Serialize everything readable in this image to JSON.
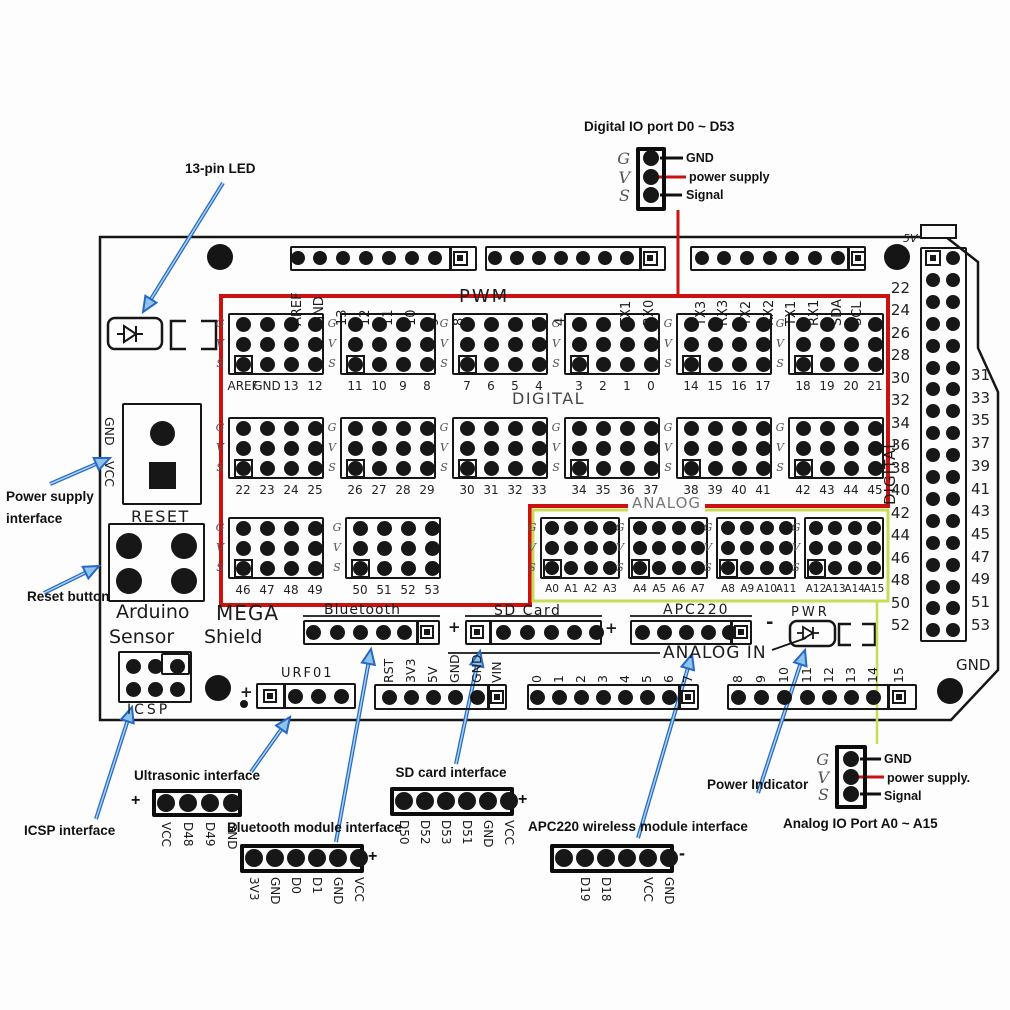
{
  "colors": {
    "red": "#cc1111",
    "yellow_green": "#c9dc55",
    "arrow_blue": "#2668c4",
    "arrow_fill": "#8ec4ec",
    "ink": "#161616"
  },
  "callouts": {
    "digital_io_title": "Digital IO port D0 ~ D53",
    "analog_io_title": "Analog IO Port A0 ~ A15",
    "led": "13-pin LED",
    "power_supply_line1": "Power supply",
    "power_supply_line2": "interface",
    "reset_button": "Reset button",
    "icsp": "ICSP interface",
    "power_indicator": "Power Indicator",
    "legend_top": {
      "g": "G",
      "v": "V",
      "s": "S",
      "gnd": "GND",
      "power": "power supply",
      "signal": "Signal"
    },
    "legend_bottom": {
      "g": "G",
      "v": "V",
      "s": "S",
      "gnd": "GND",
      "power": "power supply.",
      "signal": "Signal"
    }
  },
  "board": {
    "five_v": "5V",
    "pwm": "PWM",
    "digital": "DIGITAL",
    "digital_side": "DIGITAL",
    "analog": "ANALOG",
    "analog_in": "ANALOG IN",
    "gnd_corner": "GND",
    "gvs": [
      "G",
      "V",
      "S"
    ],
    "top_headers": [
      [
        "AREF",
        "GND",
        "13",
        "12",
        "11",
        "10",
        "9",
        "8"
      ],
      [
        "7",
        "6",
        "5",
        "4",
        "3",
        "2",
        "TX1",
        "RX0"
      ],
      [
        "TX3",
        "RX3",
        "TX2",
        "RX2",
        "TX1",
        "RX1",
        "SDA",
        "SCL"
      ]
    ],
    "grid": [
      [
        [
          "AREF",
          "GND",
          "13",
          "12"
        ],
        [
          "11",
          "10",
          "9",
          "8"
        ],
        [
          "7",
          "6",
          "5",
          "4"
        ],
        [
          "3",
          "2",
          "1",
          "0"
        ],
        [
          "14",
          "15",
          "16",
          "17"
        ],
        [
          "18",
          "19",
          "20",
          "21"
        ]
      ],
      [
        [
          "22",
          "23",
          "24",
          "25"
        ],
        [
          "26",
          "27",
          "28",
          "29"
        ],
        [
          "30",
          "31",
          "32",
          "33"
        ],
        [
          "34",
          "35",
          "36",
          "37"
        ],
        [
          "38",
          "39",
          "40",
          "41"
        ],
        [
          "42",
          "43",
          "44",
          "45"
        ]
      ],
      [
        [
          "46",
          "47",
          "48",
          "49"
        ],
        [
          "50",
          "51",
          "52",
          "53"
        ],
        [
          "A0",
          "A1",
          "A2",
          "A3"
        ],
        [
          "A4",
          "A5",
          "A6",
          "A7"
        ],
        [
          "A8",
          "A9",
          "A10",
          "A11"
        ],
        [
          "A12",
          "A13",
          "A14",
          "A15"
        ]
      ]
    ],
    "right_numbers_left": [
      "22",
      "24",
      "26",
      "28",
      "30",
      "32",
      "34",
      "36",
      "38",
      "40",
      "42",
      "44",
      "46",
      "48",
      "50",
      "52"
    ],
    "right_numbers_right": [
      "31",
      "33",
      "35",
      "37",
      "39",
      "41",
      "43",
      "45",
      "47",
      "49",
      "51",
      "53"
    ],
    "jack": {
      "gnd": "GND",
      "vcc": "VCC"
    },
    "silk": {
      "reset": "RESET",
      "arduino": "Arduino",
      "sensor": "Sensor",
      "mega": "MEGA",
      "shield": "Shield",
      "icsp": "ICSP",
      "urf01": "URF01",
      "pwr": "PWR",
      "urf_plus": "+"
    },
    "modules": [
      {
        "label": "Bluetooth",
        "sign": "+"
      },
      {
        "label": "SD Card",
        "sign": "+"
      },
      {
        "label": "APC220",
        "sign": "-"
      }
    ],
    "bottom_header": [
      "RST",
      "3V3",
      "5V",
      "GND",
      "GND",
      "VIN"
    ],
    "analog_in_numbers": [
      "0",
      "1",
      "2",
      "3",
      "4",
      "5",
      "6",
      "7",
      "8",
      "9",
      "10",
      "11",
      "12",
      "13",
      "14",
      "15"
    ]
  },
  "connectors": [
    {
      "title": "Ultrasonic interface",
      "sign": "+",
      "pins": [
        "VCC",
        "D48",
        "D49",
        "GND"
      ]
    },
    {
      "title": "Bluetooth module interface",
      "sign": "+",
      "pins": [
        "3V3",
        "GND",
        "D0",
        "D1",
        "GND",
        "VCC"
      ]
    },
    {
      "title": "SD card interface",
      "sign": "+",
      "pins": [
        "D50",
        "D52",
        "D53",
        "D51",
        "GND",
        "VCC"
      ]
    },
    {
      "title": "APC220 wireless module interface",
      "sign": "-",
      "pins": [
        "",
        "D19",
        "D18",
        "",
        "VCC",
        "GND"
      ]
    }
  ]
}
